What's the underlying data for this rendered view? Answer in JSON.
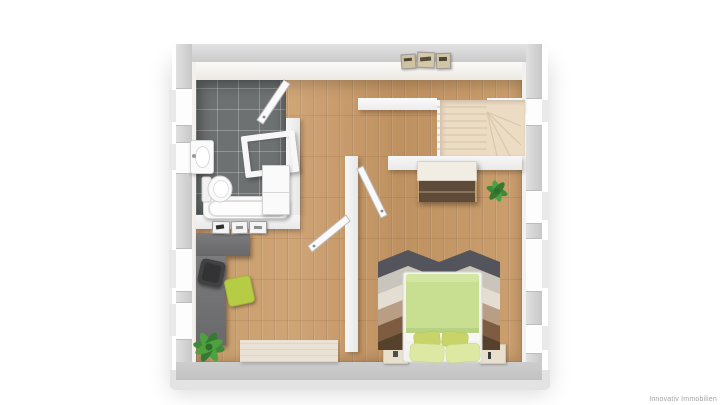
{
  "watermark": {
    "text": "Innovativ Immobilien"
  },
  "scene": {
    "kind": "3d-floorplan-top-view",
    "rooms": [
      {
        "name": "bathroom",
        "floor": "dark-gray-tile"
      },
      {
        "name": "hallway",
        "floor": "wood"
      },
      {
        "name": "staircase",
        "floor": "cream-treads"
      },
      {
        "name": "bedroom",
        "floor": "wood"
      },
      {
        "name": "office",
        "floor": "wood"
      }
    ],
    "furniture": {
      "bathroom": [
        "washbasin",
        "toilet",
        "bathtub",
        "vanity-frame",
        "cabinet",
        "door-leaf"
      ],
      "hallway": [
        "picture-frames-x3"
      ],
      "bedroom": [
        "wardrobe",
        "potted-plant",
        "chevron-rug",
        "double-bed-green",
        "pillows-x4",
        "nightstand-left",
        "nightstand-right",
        "door-leaf"
      ],
      "office": [
        "l-shaped-desk",
        "office-chair-dark",
        "chair-lime",
        "potted-plant",
        "light-rug",
        "picture-frames-x3",
        "door-leaf"
      ]
    },
    "window_count": {
      "left_wall": 4,
      "right_wall": 4
    }
  },
  "colors": {
    "background": "#ffffff",
    "exterior_wall": "#cfcfcf",
    "interior_wall": "#f2f2f2",
    "wood_floor": "#c69a68",
    "bathroom_tile": "#6d7171",
    "stair_tread": "#ecdcc4",
    "wardrobe_front": "#5d4a38",
    "bed_duvet": "#c8df92",
    "pillow_dark": "#c9d468",
    "pillow_light": "#dde9a2",
    "rug_chevron": [
      "#54545c",
      "#c9c5bc",
      "#e3ddd2",
      "#b89e84",
      "#7d5c42",
      "#56412d"
    ],
    "desk": "#6f6f71",
    "chair_lime": "#b7cc45",
    "plant_green": "#3e8a38",
    "office_rug": "#eae3d5",
    "watermark_text": "#a6a3a0"
  }
}
